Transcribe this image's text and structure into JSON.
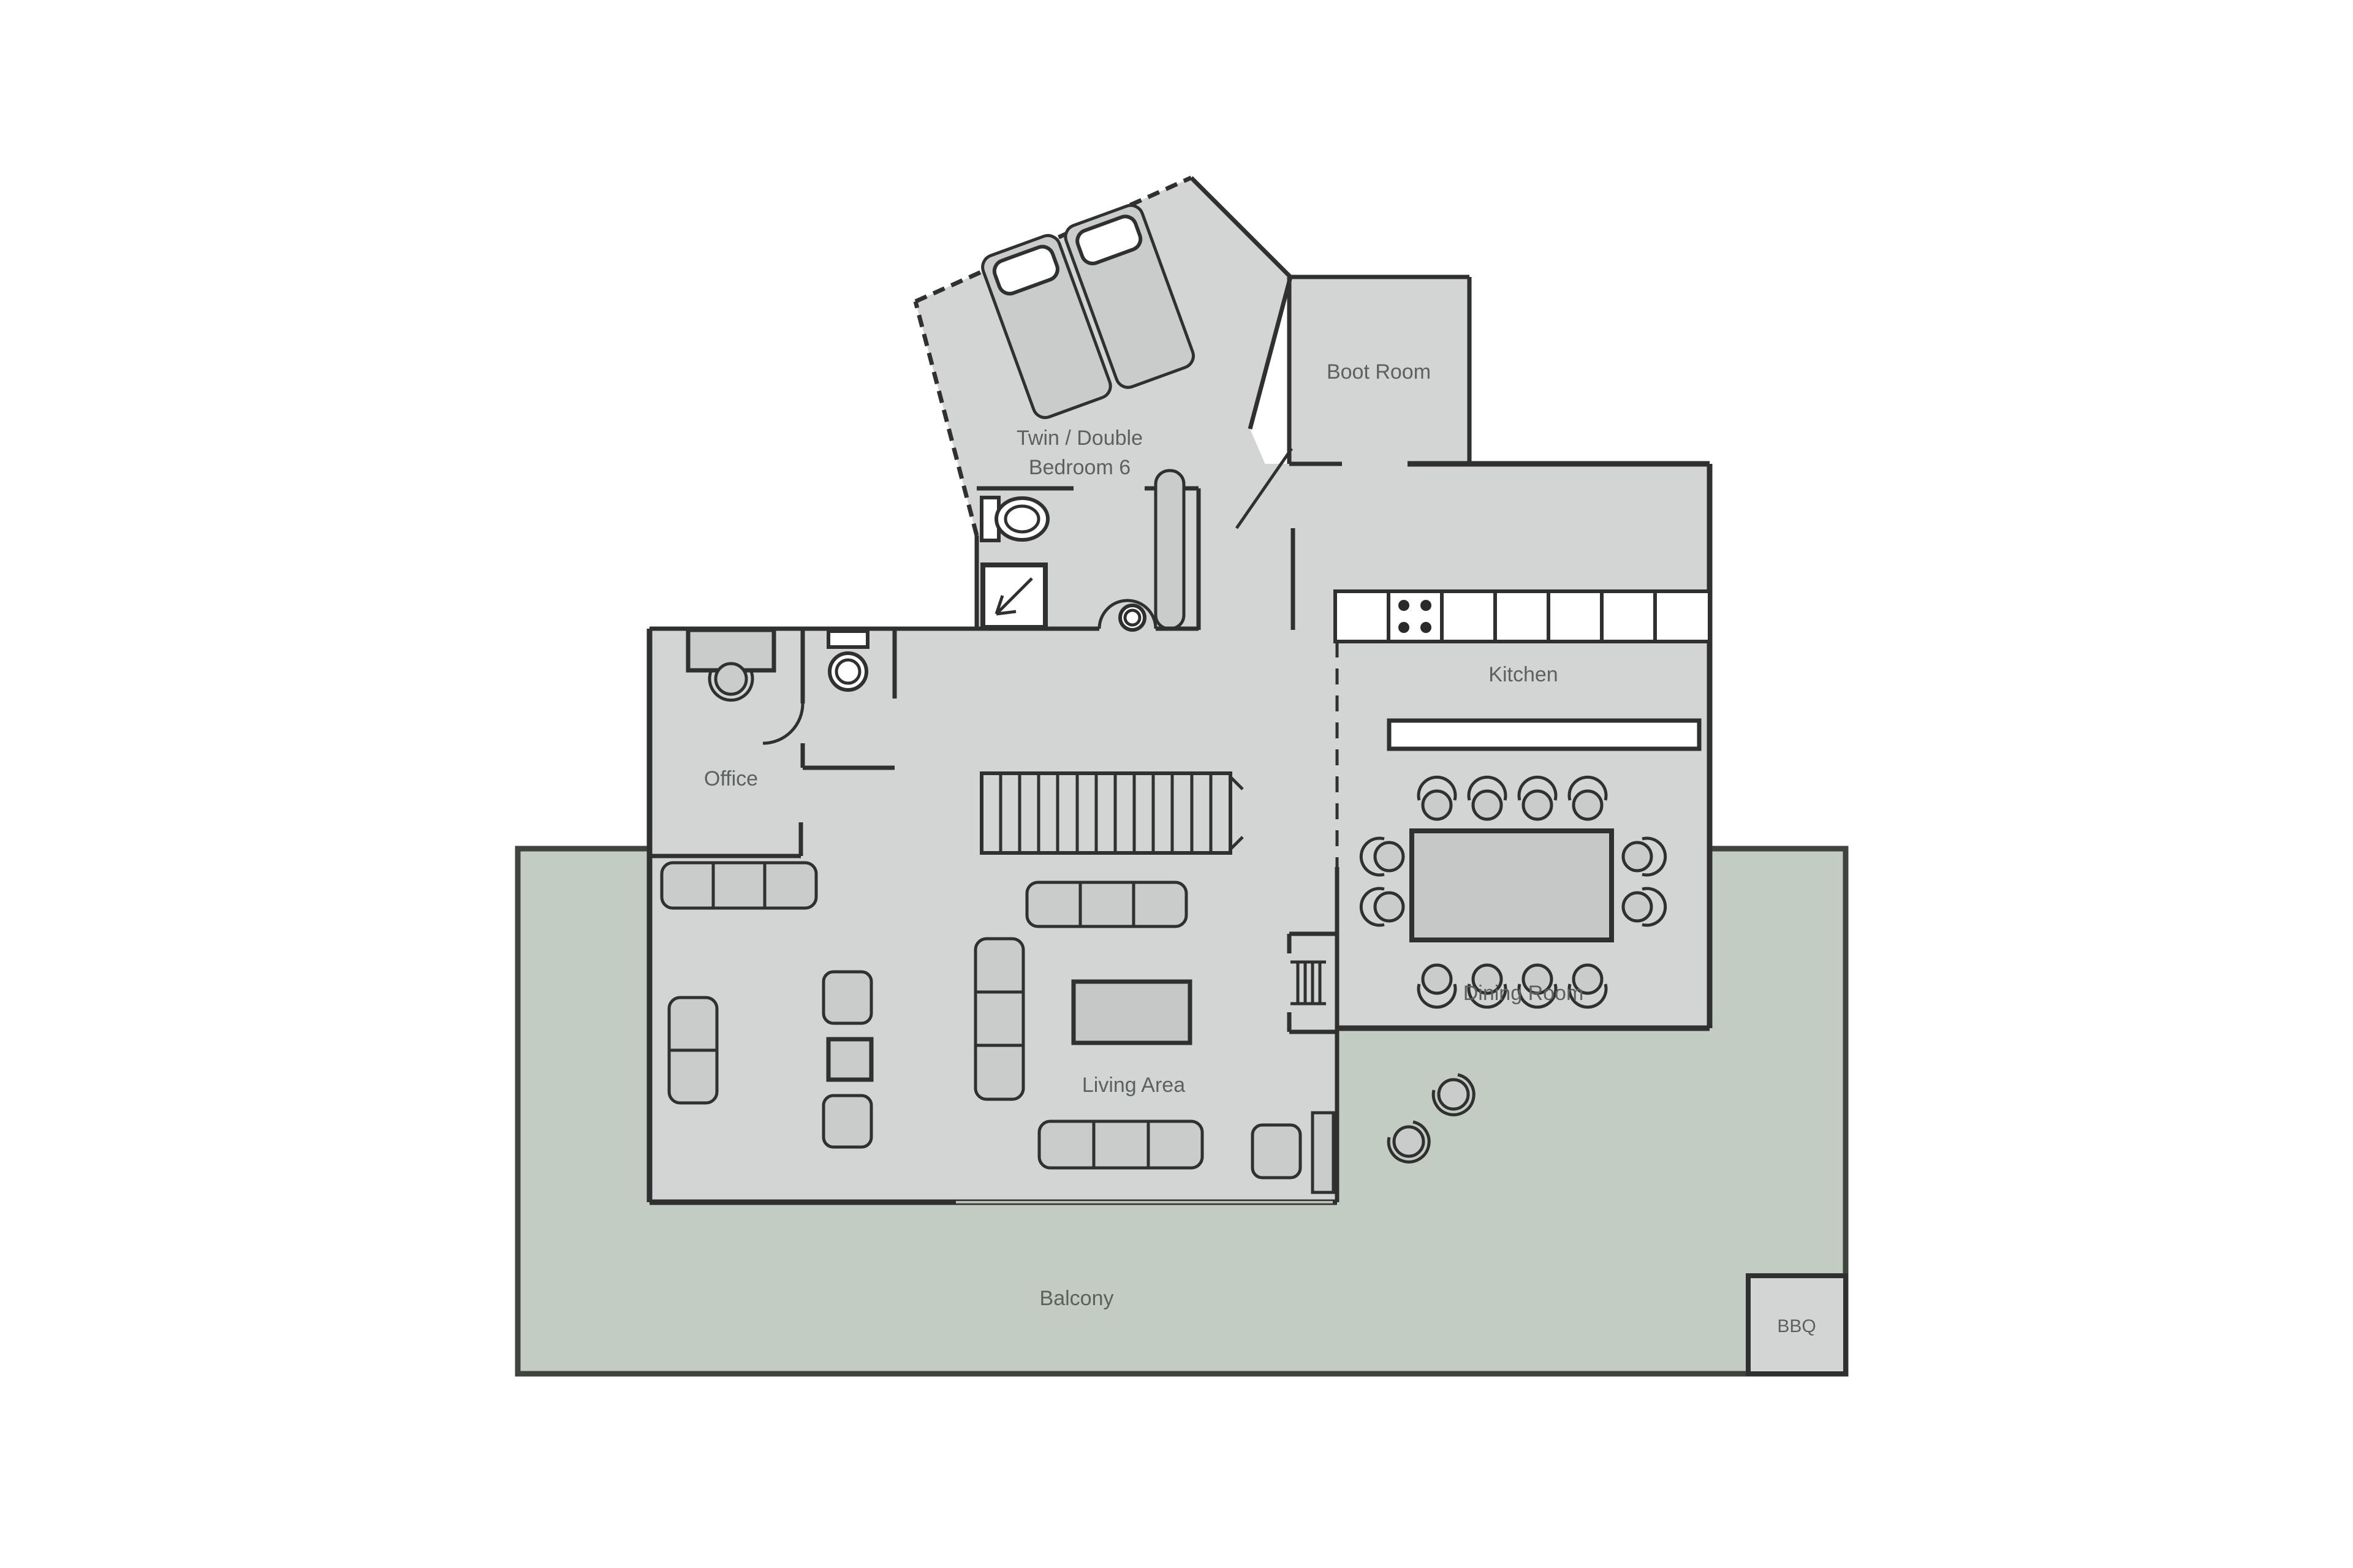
{
  "plan": {
    "title": "Chalet floor plan",
    "rooms": {
      "bedroom6": {
        "label_line1": "Twin / Double",
        "label_line2": "Bedroom 6"
      },
      "boot_room": {
        "label": "Boot Room"
      },
      "kitchen": {
        "label": "Kitchen"
      },
      "office": {
        "label": "Office"
      },
      "living_area": {
        "label": "Living Area"
      },
      "dining_room": {
        "label": "Dining Room"
      },
      "balcony": {
        "label": "Balcony"
      },
      "bbq": {
        "label": "BBQ"
      }
    },
    "fixtures": [
      "twin-beds",
      "toilet",
      "shower",
      "wardrobe",
      "basin",
      "desk",
      "office-chair",
      "wc-toilet",
      "staircase",
      "steps",
      "sofa-3-seat",
      "sofa-2-seat",
      "armchair",
      "side-table",
      "coffee-table",
      "tv-unit",
      "dining-table",
      "dining-chairs",
      "kitchen-counter",
      "hob",
      "kitchen-island",
      "balcony-chairs",
      "bbq-grill"
    ],
    "colors": {
      "wall": "#303030",
      "wallOuter": "#3f453e",
      "floor": "#d3d5d4",
      "balcony": "#c2ccc3",
      "furn": "#c9ccca",
      "fixture": "#ffffff",
      "table": "#c5c8c6",
      "text": "#5d615e",
      "glass": "#b9bfb8"
    }
  }
}
